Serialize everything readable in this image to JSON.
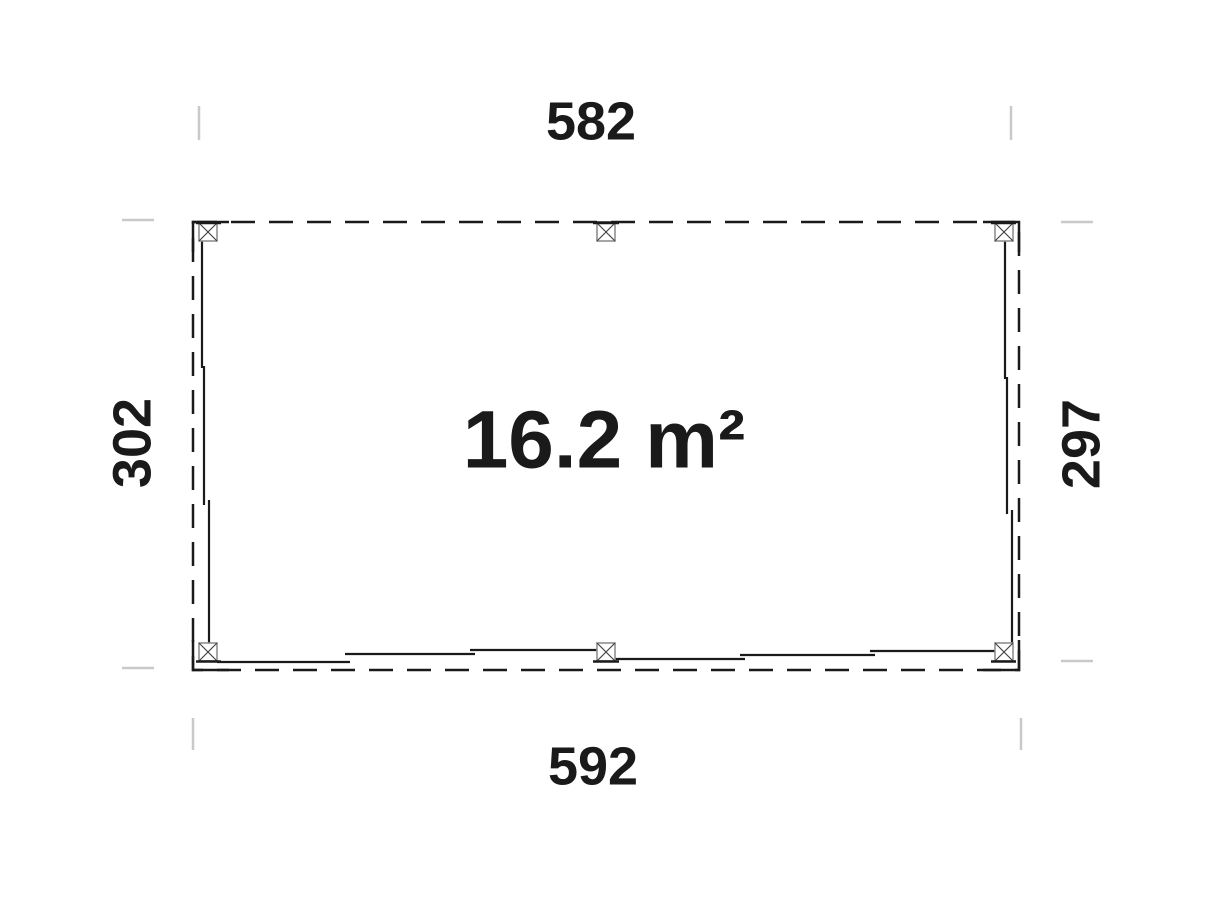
{
  "diagram": {
    "type": "floor-plan",
    "area_label": "16.2 m²",
    "dimensions": {
      "top": "582",
      "bottom": "592",
      "left": "302",
      "right": "297"
    },
    "posts": {
      "marker": "square-with-x-post-icon",
      "count": 6
    },
    "colors": {
      "line": "#1a1a1a",
      "extension_line": "#c9c9c9",
      "post_outline": "#8f8f8f",
      "background": "#ffffff"
    }
  }
}
